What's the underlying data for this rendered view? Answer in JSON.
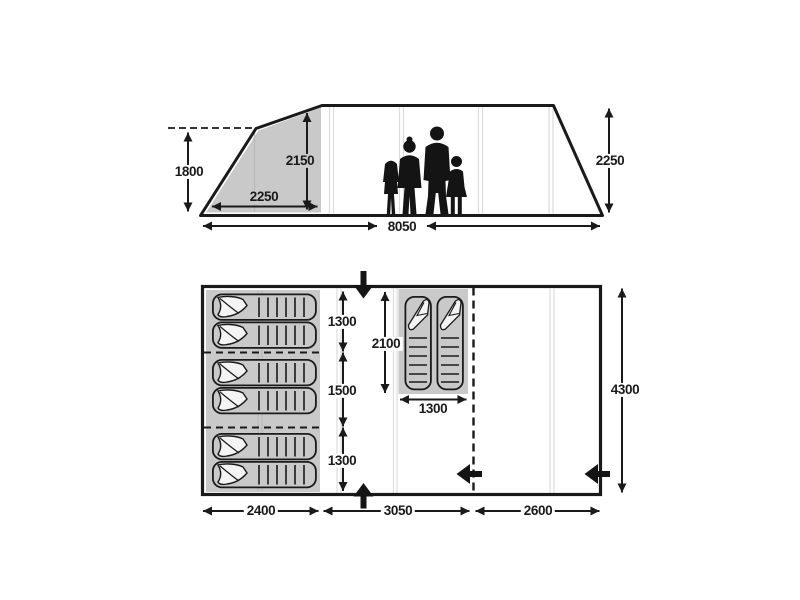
{
  "diagram_title": "tent-dimensions-diagram",
  "colors": {
    "line": "#1a1a1a",
    "shaded_panel": "#c9c9c9",
    "seam": "#dcdcdc",
    "seam_on_gray": "#b9b9b9",
    "pillow": "#f4f4f4",
    "silhouette": "#141414",
    "background": "#ffffff"
  },
  "icons": {
    "door_arrow_top": "arrow-down",
    "door_arrow_bottom": "arrow-up",
    "door_arrow_divider": "arrow-left",
    "door_arrow_side": "arrow-left"
  },
  "elevation": {
    "height_front": "1800",
    "bedroom_width": "2250",
    "bedroom_height": "2150",
    "rear_height": "2250",
    "total_length": "8050"
  },
  "floorplan": {
    "section_top_depth": "1300",
    "section_middle_depth": "1500",
    "section_bottom_depth": "1300",
    "inner_tent_depth": "2100",
    "inner_tent_width": "1300",
    "total_depth": "4300",
    "bedroom_width": "2400",
    "living_width": "3050",
    "front_width": "2600"
  }
}
